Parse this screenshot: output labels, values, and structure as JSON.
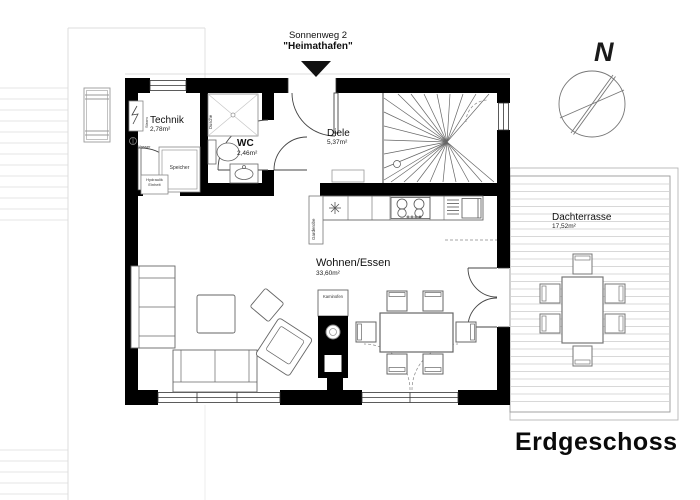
{
  "header": {
    "street": "Sonnenweg 2",
    "house_name": "\"Heimathafen\""
  },
  "floor_label": "Erdgeschoss",
  "compass_label": "N",
  "rooms": {
    "technik": {
      "name": "Technik",
      "area": "2,78m²"
    },
    "wc": {
      "name": "WC",
      "area": "2,46m²"
    },
    "diele": {
      "name": "Diele",
      "area": "5,37m²"
    },
    "wohnen_essen": {
      "name": "Wohnen/Essen",
      "area": "33,60m²"
    },
    "dachterrasse": {
      "name": "Dachterrasse",
      "area": "17,52m²"
    }
  },
  "annotations": {
    "speicher": "Speicher",
    "kaminofen": "Kaminofen",
    "garderobe": "Garderobe",
    "hydraulik_line1": "Hydraulik",
    "hydraulik_line2": "Einheit",
    "strom": "Strom",
    "wasser": "Wasser",
    "dusche": "Dusche"
  },
  "colors": {
    "wall": "#000000",
    "furniture_line": "#666666",
    "deck_line": "#d8d8d8"
  }
}
